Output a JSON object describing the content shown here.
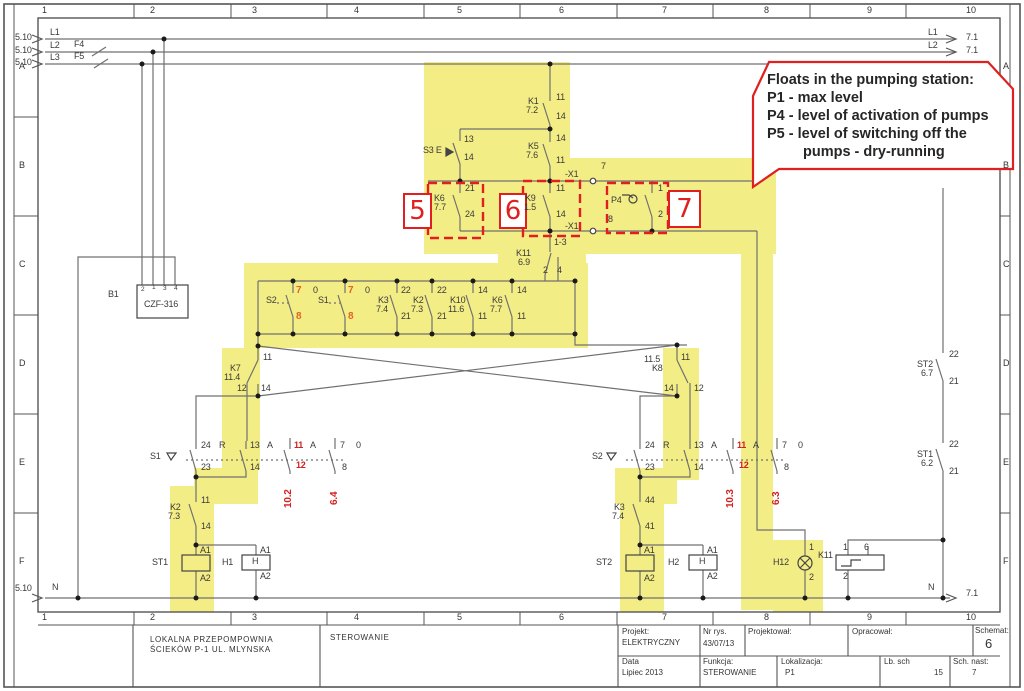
{
  "colors": {
    "highlight": "#f1e968",
    "annotation": "#e02020",
    "wire": "#707070",
    "red_text": "#d32020",
    "orange_text": "#e2641e"
  },
  "callout": {
    "lines": [
      "Floats in the pumping station:",
      "P1 - max level",
      "P4 - level of activation of pumps",
      "P5 - level of switching off the",
      "pumps - dry-running"
    ]
  },
  "red_boxes": {
    "box5": "5",
    "box6": "6",
    "box7": "7"
  },
  "border": {
    "columns": [
      "1",
      "2",
      "3",
      "4",
      "5",
      "6",
      "7",
      "8",
      "9",
      "10"
    ],
    "col_x": [
      42,
      150,
      252,
      354,
      457,
      559,
      662,
      764,
      867,
      966
    ],
    "rows": [
      "A",
      "B",
      "C",
      "D",
      "E",
      "F"
    ],
    "row_y": [
      62,
      161,
      260,
      359,
      458,
      557
    ]
  },
  "title_block": {
    "name_line1": "LOKALNA PRZEPOMPOWNIA",
    "name_line2": "ŚCIEKÓW  P-1  UL. MLYNSKA",
    "function_cell": "STEROWANIE",
    "projekt_label": "Projekt:",
    "projekt_value": "ELEKTRYCZNY",
    "nr_rys_label": "Nr rys.",
    "nr_rys_value": "43/07/13",
    "projektowal_label": "Projektował:",
    "opracowal_label": "Opracował:",
    "schemat_label": "Schemat:",
    "schemat_value": "6",
    "data_label": "Data",
    "data_value": "Lipiec 2013",
    "funkcja_label": "Funkcja:",
    "funkcja_value": "STEROWANIE",
    "lokalizacja_label": "Lokalizacja:",
    "lokalizacja_value": "P1",
    "lb_sch_label": "Lb. sch",
    "lb_sch_value": "15",
    "sch_nast_label": "Sch. nast:",
    "sch_nast_value": "7"
  },
  "labels": [
    {
      "t": "5.10",
      "x": 15,
      "y": 33
    },
    {
      "t": "L1",
      "x": 50,
      "y": 28
    },
    {
      "t": "5.10",
      "x": 15,
      "y": 46
    },
    {
      "t": "L2",
      "x": 50,
      "y": 41
    },
    {
      "t": "F4",
      "x": 74,
      "y": 40
    },
    {
      "t": "5.10",
      "x": 15,
      "y": 58
    },
    {
      "t": "L3",
      "x": 50,
      "y": 53
    },
    {
      "t": "F5",
      "x": 74,
      "y": 52
    },
    {
      "t": "L1",
      "x": 928,
      "y": 28
    },
    {
      "t": "7.1",
      "x": 966,
      "y": 33
    },
    {
      "t": "L2",
      "x": 928,
      "y": 41
    },
    {
      "t": "7.1",
      "x": 966,
      "y": 46
    },
    {
      "t": "5.10",
      "x": 15,
      "y": 584
    },
    {
      "t": "N",
      "x": 52,
      "y": 583
    },
    {
      "t": "N",
      "x": 928,
      "y": 583
    },
    {
      "t": "7.1",
      "x": 966,
      "y": 589
    },
    {
      "t": "B1",
      "x": 108,
      "y": 290
    },
    {
      "t": "CZF-316",
      "x": 144,
      "y": 300
    },
    {
      "t": "2",
      "x": 141,
      "y": 287,
      "c": "tiny"
    },
    {
      "t": "1",
      "x": 152,
      "y": 285,
      "c": "tiny"
    },
    {
      "t": "3",
      "x": 163,
      "y": 286,
      "c": "tiny"
    },
    {
      "t": "4",
      "x": 174,
      "y": 286,
      "c": "tiny"
    },
    {
      "t": "11",
      "x": 556,
      "y": 93
    },
    {
      "t": "K1",
      "x": 528,
      "y": 97
    },
    {
      "t": "7.2",
      "x": 526,
      "y": 106
    },
    {
      "t": "14",
      "x": 556,
      "y": 112
    },
    {
      "t": "13",
      "x": 464,
      "y": 135
    },
    {
      "t": "S3 E",
      "x": 423,
      "y": 146
    },
    {
      "t": "14",
      "x": 464,
      "y": 153
    },
    {
      "t": "14",
      "x": 556,
      "y": 134
    },
    {
      "t": "K5",
      "x": 528,
      "y": 142
    },
    {
      "t": "7.6",
      "x": 526,
      "y": 151
    },
    {
      "t": "11",
      "x": 556,
      "y": 156
    },
    {
      "t": "-X1",
      "x": 565,
      "y": 170
    },
    {
      "t": "7",
      "x": 601,
      "y": 162
    },
    {
      "t": "21",
      "x": 465,
      "y": 184
    },
    {
      "t": "K6",
      "x": 434,
      "y": 194
    },
    {
      "t": "7.7",
      "x": 434,
      "y": 203
    },
    {
      "t": "24",
      "x": 465,
      "y": 210
    },
    {
      "t": "11",
      "x": 556,
      "y": 184
    },
    {
      "t": "K9",
      "x": 525,
      "y": 194
    },
    {
      "t": "1.5",
      "x": 524,
      "y": 203
    },
    {
      "t": "14",
      "x": 556,
      "y": 210
    },
    {
      "t": "P4",
      "x": 611,
      "y": 196
    },
    {
      "t": "1",
      "x": 658,
      "y": 184
    },
    {
      "t": "2",
      "x": 658,
      "y": 210
    },
    {
      "t": "-X1",
      "x": 565,
      "y": 222
    },
    {
      "t": "8",
      "x": 608,
      "y": 215
    },
    {
      "t": "1-3",
      "x": 554,
      "y": 238
    },
    {
      "t": "K11",
      "x": 516,
      "y": 249
    },
    {
      "t": "6.9",
      "x": 518,
      "y": 258
    },
    {
      "t": "2",
      "x": 543,
      "y": 266
    },
    {
      "t": "4",
      "x": 557,
      "y": 266
    },
    {
      "t": "S2",
      "x": 266,
      "y": 296
    },
    {
      "t": "7",
      "x": 296,
      "y": 286,
      "c": "orange"
    },
    {
      "t": "0",
      "x": 313,
      "y": 286
    },
    {
      "t": "8",
      "x": 296,
      "y": 312,
      "c": "orange"
    },
    {
      "t": "S1",
      "x": 318,
      "y": 296
    },
    {
      "t": "7",
      "x": 348,
      "y": 286,
      "c": "orange"
    },
    {
      "t": "0",
      "x": 365,
      "y": 286
    },
    {
      "t": "8",
      "x": 348,
      "y": 312,
      "c": "orange"
    },
    {
      "t": "22",
      "x": 401,
      "y": 286
    },
    {
      "t": "K3",
      "x": 378,
      "y": 296
    },
    {
      "t": "7.4",
      "x": 376,
      "y": 305
    },
    {
      "t": "21",
      "x": 401,
      "y": 312
    },
    {
      "t": "22",
      "x": 437,
      "y": 286
    },
    {
      "t": "K2",
      "x": 413,
      "y": 296
    },
    {
      "t": "7.3",
      "x": 411,
      "y": 305
    },
    {
      "t": "21",
      "x": 437,
      "y": 312
    },
    {
      "t": "14",
      "x": 478,
      "y": 286
    },
    {
      "t": "K10",
      "x": 450,
      "y": 296
    },
    {
      "t": "11.6",
      "x": 448,
      "y": 305
    },
    {
      "t": "11",
      "x": 478,
      "y": 312
    },
    {
      "t": "14",
      "x": 517,
      "y": 286
    },
    {
      "t": "K6",
      "x": 492,
      "y": 296
    },
    {
      "t": "7.7",
      "x": 490,
      "y": 305
    },
    {
      "t": "11",
      "x": 517,
      "y": 312
    },
    {
      "t": "11",
      "x": 263,
      "y": 353
    },
    {
      "t": "K7",
      "x": 230,
      "y": 364
    },
    {
      "t": "11.4",
      "x": 224,
      "y": 373
    },
    {
      "t": "12",
      "x": 237,
      "y": 384
    },
    {
      "t": "14",
      "x": 261,
      "y": 384
    },
    {
      "t": "11.5",
      "x": 644,
      "y": 355
    },
    {
      "t": "K8",
      "x": 652,
      "y": 364
    },
    {
      "t": "11",
      "x": 681,
      "y": 353
    },
    {
      "t": "14",
      "x": 664,
      "y": 384
    },
    {
      "t": "12",
      "x": 694,
      "y": 384
    },
    {
      "t": "S1",
      "x": 150,
      "y": 452
    },
    {
      "t": "24",
      "x": 201,
      "y": 441
    },
    {
      "t": "R",
      "x": 219,
      "y": 441
    },
    {
      "t": "23",
      "x": 201,
      "y": 463
    },
    {
      "t": "13",
      "x": 250,
      "y": 441
    },
    {
      "t": "A",
      "x": 267,
      "y": 441
    },
    {
      "t": "14",
      "x": 250,
      "y": 463
    },
    {
      "t": "11",
      "x": 294,
      "y": 441,
      "c": "red"
    },
    {
      "t": "A",
      "x": 310,
      "y": 441
    },
    {
      "t": "12",
      "x": 296,
      "y": 461,
      "c": "red"
    },
    {
      "t": "7",
      "x": 340,
      "y": 441
    },
    {
      "t": "0",
      "x": 356,
      "y": 441
    },
    {
      "t": "8",
      "x": 342,
      "y": 463
    },
    {
      "t": "10.2",
      "x": 284,
      "y": 508,
      "c": "rot"
    },
    {
      "t": "6.4",
      "x": 330,
      "y": 505,
      "c": "rot"
    },
    {
      "t": "11",
      "x": 201,
      "y": 496
    },
    {
      "t": "K2",
      "x": 170,
      "y": 503
    },
    {
      "t": "7.3",
      "x": 168,
      "y": 512
    },
    {
      "t": "14",
      "x": 201,
      "y": 522
    },
    {
      "t": "A1",
      "x": 200,
      "y": 546
    },
    {
      "t": "ST1",
      "x": 152,
      "y": 558
    },
    {
      "t": "A2",
      "x": 200,
      "y": 574
    },
    {
      "t": "A1",
      "x": 260,
      "y": 546
    },
    {
      "t": "H1",
      "x": 222,
      "y": 558
    },
    {
      "t": "H",
      "x": 252,
      "y": 557
    },
    {
      "t": "A2",
      "x": 260,
      "y": 572
    },
    {
      "t": "S2",
      "x": 592,
      "y": 452
    },
    {
      "t": "24",
      "x": 645,
      "y": 441
    },
    {
      "t": "R",
      "x": 663,
      "y": 441
    },
    {
      "t": "23",
      "x": 645,
      "y": 463
    },
    {
      "t": "13",
      "x": 694,
      "y": 441
    },
    {
      "t": "A",
      "x": 711,
      "y": 441
    },
    {
      "t": "14",
      "x": 694,
      "y": 463
    },
    {
      "t": "11",
      "x": 737,
      "y": 441,
      "c": "red"
    },
    {
      "t": "A",
      "x": 753,
      "y": 441
    },
    {
      "t": "12",
      "x": 739,
      "y": 461,
      "c": "red"
    },
    {
      "t": "7",
      "x": 782,
      "y": 441
    },
    {
      "t": "0",
      "x": 798,
      "y": 441
    },
    {
      "t": "8",
      "x": 784,
      "y": 463
    },
    {
      "t": "10.3",
      "x": 726,
      "y": 508,
      "c": "rot"
    },
    {
      "t": "6.3",
      "x": 772,
      "y": 505,
      "c": "rot"
    },
    {
      "t": "44",
      "x": 645,
      "y": 496
    },
    {
      "t": "K3",
      "x": 614,
      "y": 503
    },
    {
      "t": "7.4",
      "x": 612,
      "y": 512
    },
    {
      "t": "41",
      "x": 645,
      "y": 522
    },
    {
      "t": "A1",
      "x": 644,
      "y": 546
    },
    {
      "t": "ST2",
      "x": 596,
      "y": 558
    },
    {
      "t": "A2",
      "x": 644,
      "y": 574
    },
    {
      "t": "A1",
      "x": 707,
      "y": 546
    },
    {
      "t": "H2",
      "x": 668,
      "y": 558
    },
    {
      "t": "H",
      "x": 699,
      "y": 557
    },
    {
      "t": "A2",
      "x": 707,
      "y": 572
    },
    {
      "t": "1",
      "x": 809,
      "y": 543
    },
    {
      "t": "H12",
      "x": 773,
      "y": 558
    },
    {
      "t": "2",
      "x": 809,
      "y": 573
    },
    {
      "t": "1",
      "x": 843,
      "y": 543
    },
    {
      "t": "6",
      "x": 864,
      "y": 543
    },
    {
      "t": "K11",
      "x": 818,
      "y": 551
    },
    {
      "t": "2",
      "x": 843,
      "y": 572
    },
    {
      "t": "22",
      "x": 949,
      "y": 350
    },
    {
      "t": "ST2",
      "x": 917,
      "y": 360
    },
    {
      "t": "6.7",
      "x": 921,
      "y": 369
    },
    {
      "t": "21",
      "x": 949,
      "y": 377
    },
    {
      "t": "22",
      "x": 949,
      "y": 440
    },
    {
      "t": "ST1",
      "x": 917,
      "y": 450
    },
    {
      "t": "6.2",
      "x": 921,
      "y": 459
    },
    {
      "t": "21",
      "x": 949,
      "y": 467
    }
  ]
}
